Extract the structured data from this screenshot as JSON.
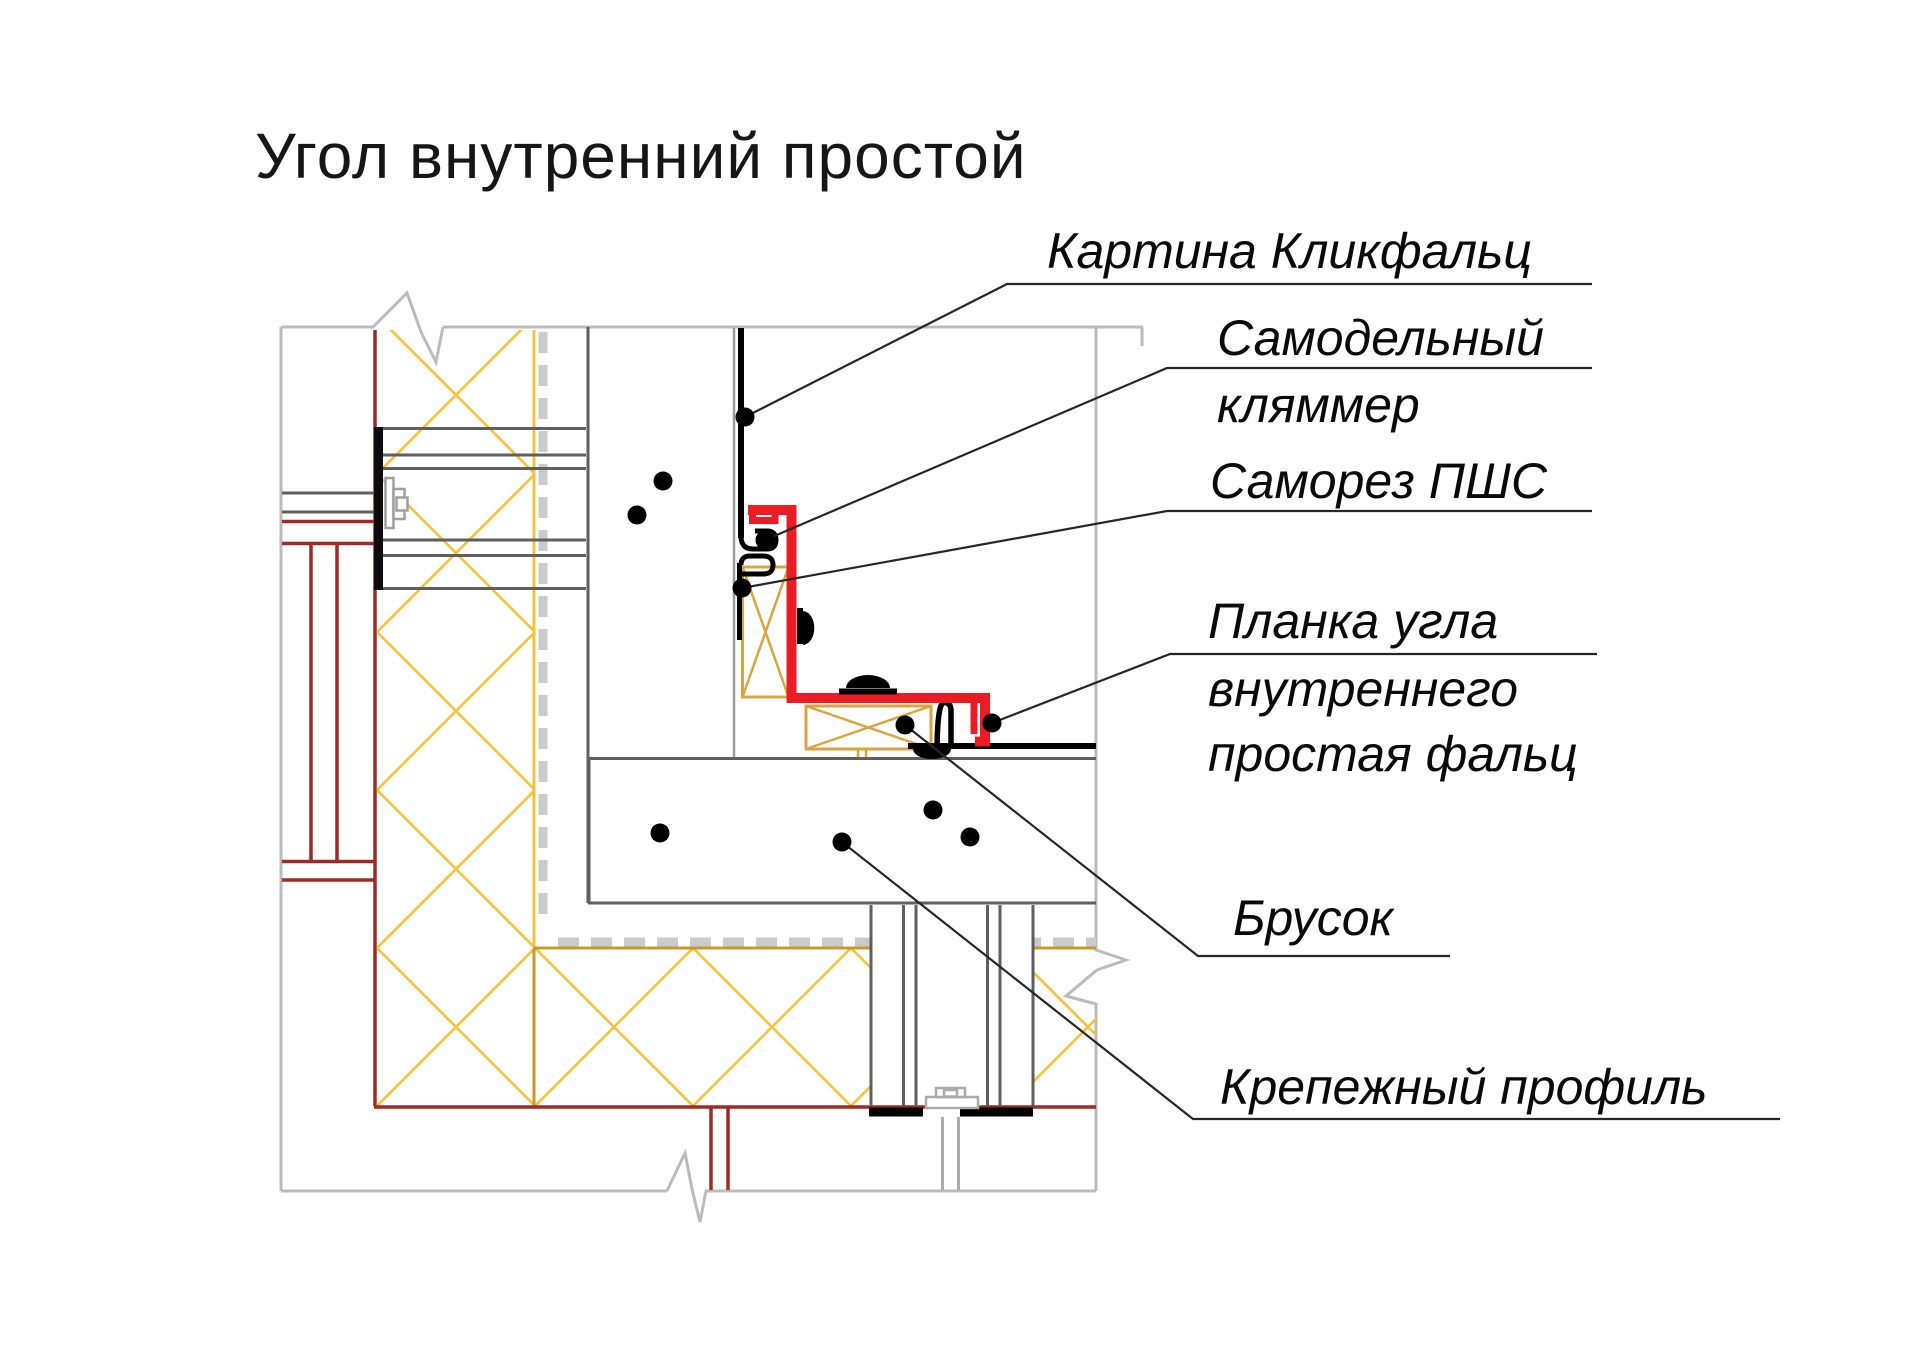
{
  "title": "Угол внутренний простой",
  "callouts": [
    {
      "id": "kartina",
      "lines": [
        "Картина Кликфальц"
      ]
    },
    {
      "id": "klyammer",
      "lines": [
        "Самодельный",
        "кляммер"
      ]
    },
    {
      "id": "samorez",
      "lines": [
        "Саморез ПШС"
      ]
    },
    {
      "id": "planka",
      "lines": [
        "Планка угла",
        "внутреннего",
        "простая фальц"
      ]
    },
    {
      "id": "brusok",
      "lines": [
        "Брусок"
      ]
    },
    {
      "id": "profil",
      "lines": [
        "Крепежный профиль"
      ]
    }
  ],
  "colors": {
    "plank_red": "#EC1C24",
    "wall_red": "#9E2B25",
    "insulation_yellow": "#F2C33B",
    "wood_tan": "#D9A441",
    "frame_gray": "#BBBBBB",
    "structure_gray": "#5F5F5F",
    "membrane_gray": "#CBCBCB",
    "ink": "#000000"
  }
}
